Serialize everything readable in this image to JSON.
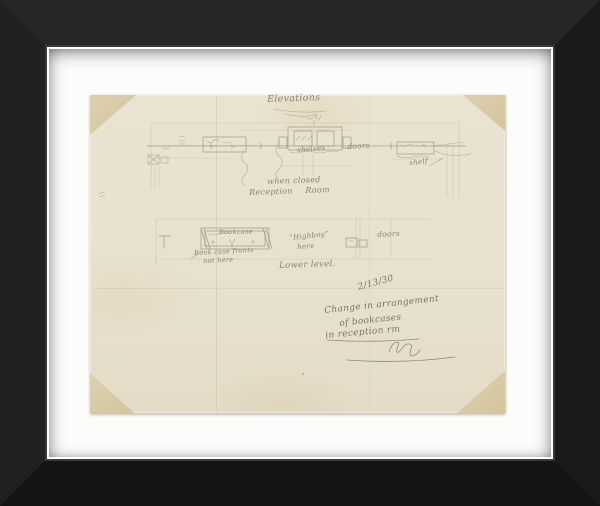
{
  "scene": {
    "type": "framed architectural pencil sketch",
    "colors": {
      "frame": "#1d1d1d",
      "mat": "#fcfcfa",
      "paper": "#e9e2cf",
      "corner_mounts": "#d9cba7",
      "pencil": "#8b8271"
    }
  },
  "inscriptions": {
    "title": "Elevations",
    "upper": {
      "shelves": "shelves",
      "doors": "doors",
      "shelf": "shelf",
      "caption1": "when closed",
      "caption2": "Reception  Room"
    },
    "lower": {
      "bookcase": "Bookcase",
      "note1": "Book case fronts",
      "note2": "not here",
      "highboy1": "“Highboy”",
      "highboy2": "here",
      "doors": "doors",
      "caption": "Lower level."
    },
    "revision": {
      "date": "2/13/30",
      "line1": "Change in arrangement",
      "line2": "of bookcases",
      "line3": "in reception rm"
    }
  }
}
